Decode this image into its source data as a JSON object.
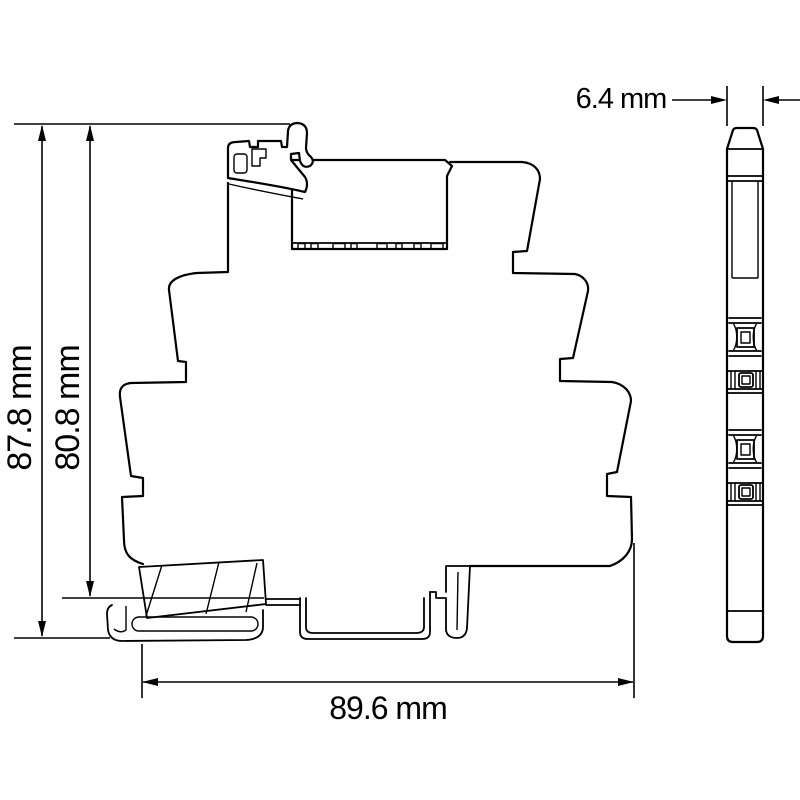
{
  "dimensions": {
    "overall_height": "87.8 mm",
    "body_height": "80.8 mm",
    "overall_width": "89.6 mm",
    "depth": "6.4 mm"
  },
  "colors": {
    "line": "#000000",
    "background": "#ffffff"
  }
}
